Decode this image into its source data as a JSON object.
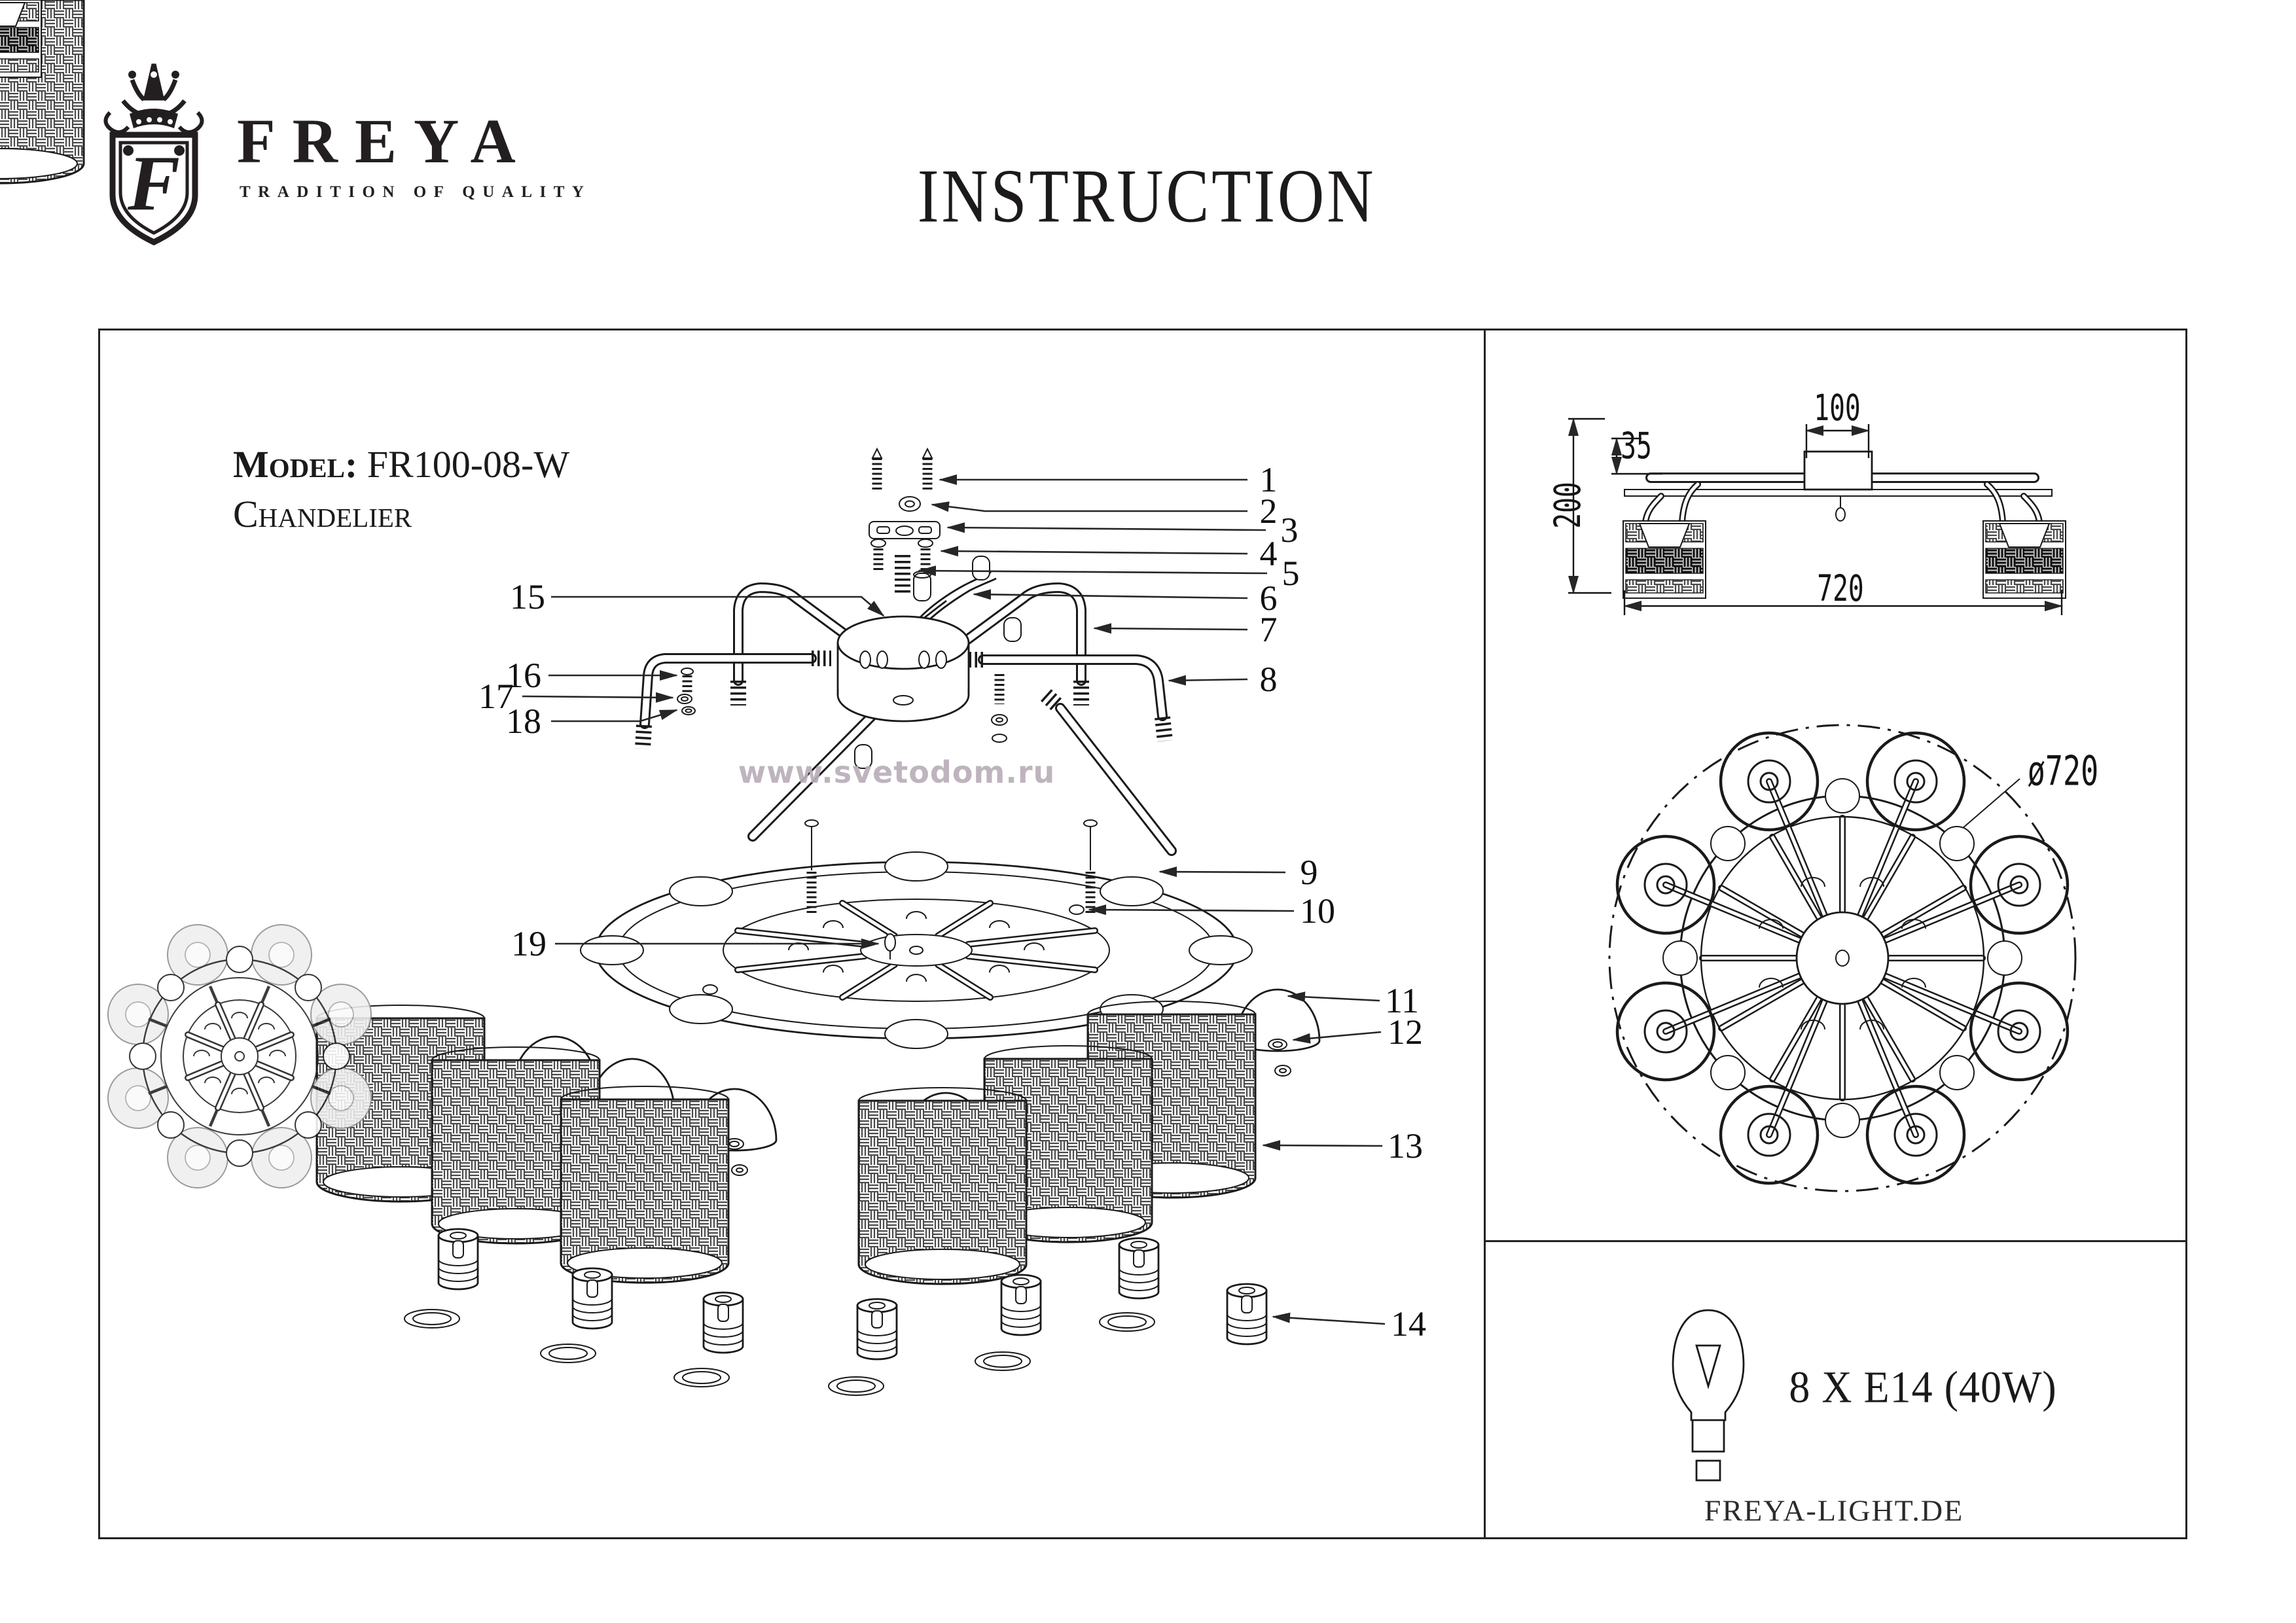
{
  "header": {
    "brand": "FREYA",
    "tagline": "TRADITION OF QUALITY",
    "title": "INSTRUCTION"
  },
  "product": {
    "model_label": "Model:",
    "model_number": "FR100-08-W",
    "product_type": "Chandelier"
  },
  "watermark": {
    "text": "www.svetodom.ru",
    "color": "#b8aeb8"
  },
  "diagram": {
    "callouts": [
      "1",
      "2",
      "3",
      "4",
      "5",
      "6",
      "7",
      "8",
      "9",
      "10",
      "11",
      "12",
      "13",
      "14",
      "15",
      "16",
      "17",
      "18",
      "19"
    ]
  },
  "side_view": {
    "dim_canopy_width": "100",
    "dim_canopy_drop": "35",
    "dim_height": "200",
    "dim_width": "720"
  },
  "top_view": {
    "dim_diameter": "ø720"
  },
  "spec": {
    "lamps": "8 X E14 (40W)",
    "website": "FREYA-LIGHT.DE"
  },
  "colors": {
    "ink": "#1a1a1a",
    "accent_gray": "#8e8e8e"
  }
}
